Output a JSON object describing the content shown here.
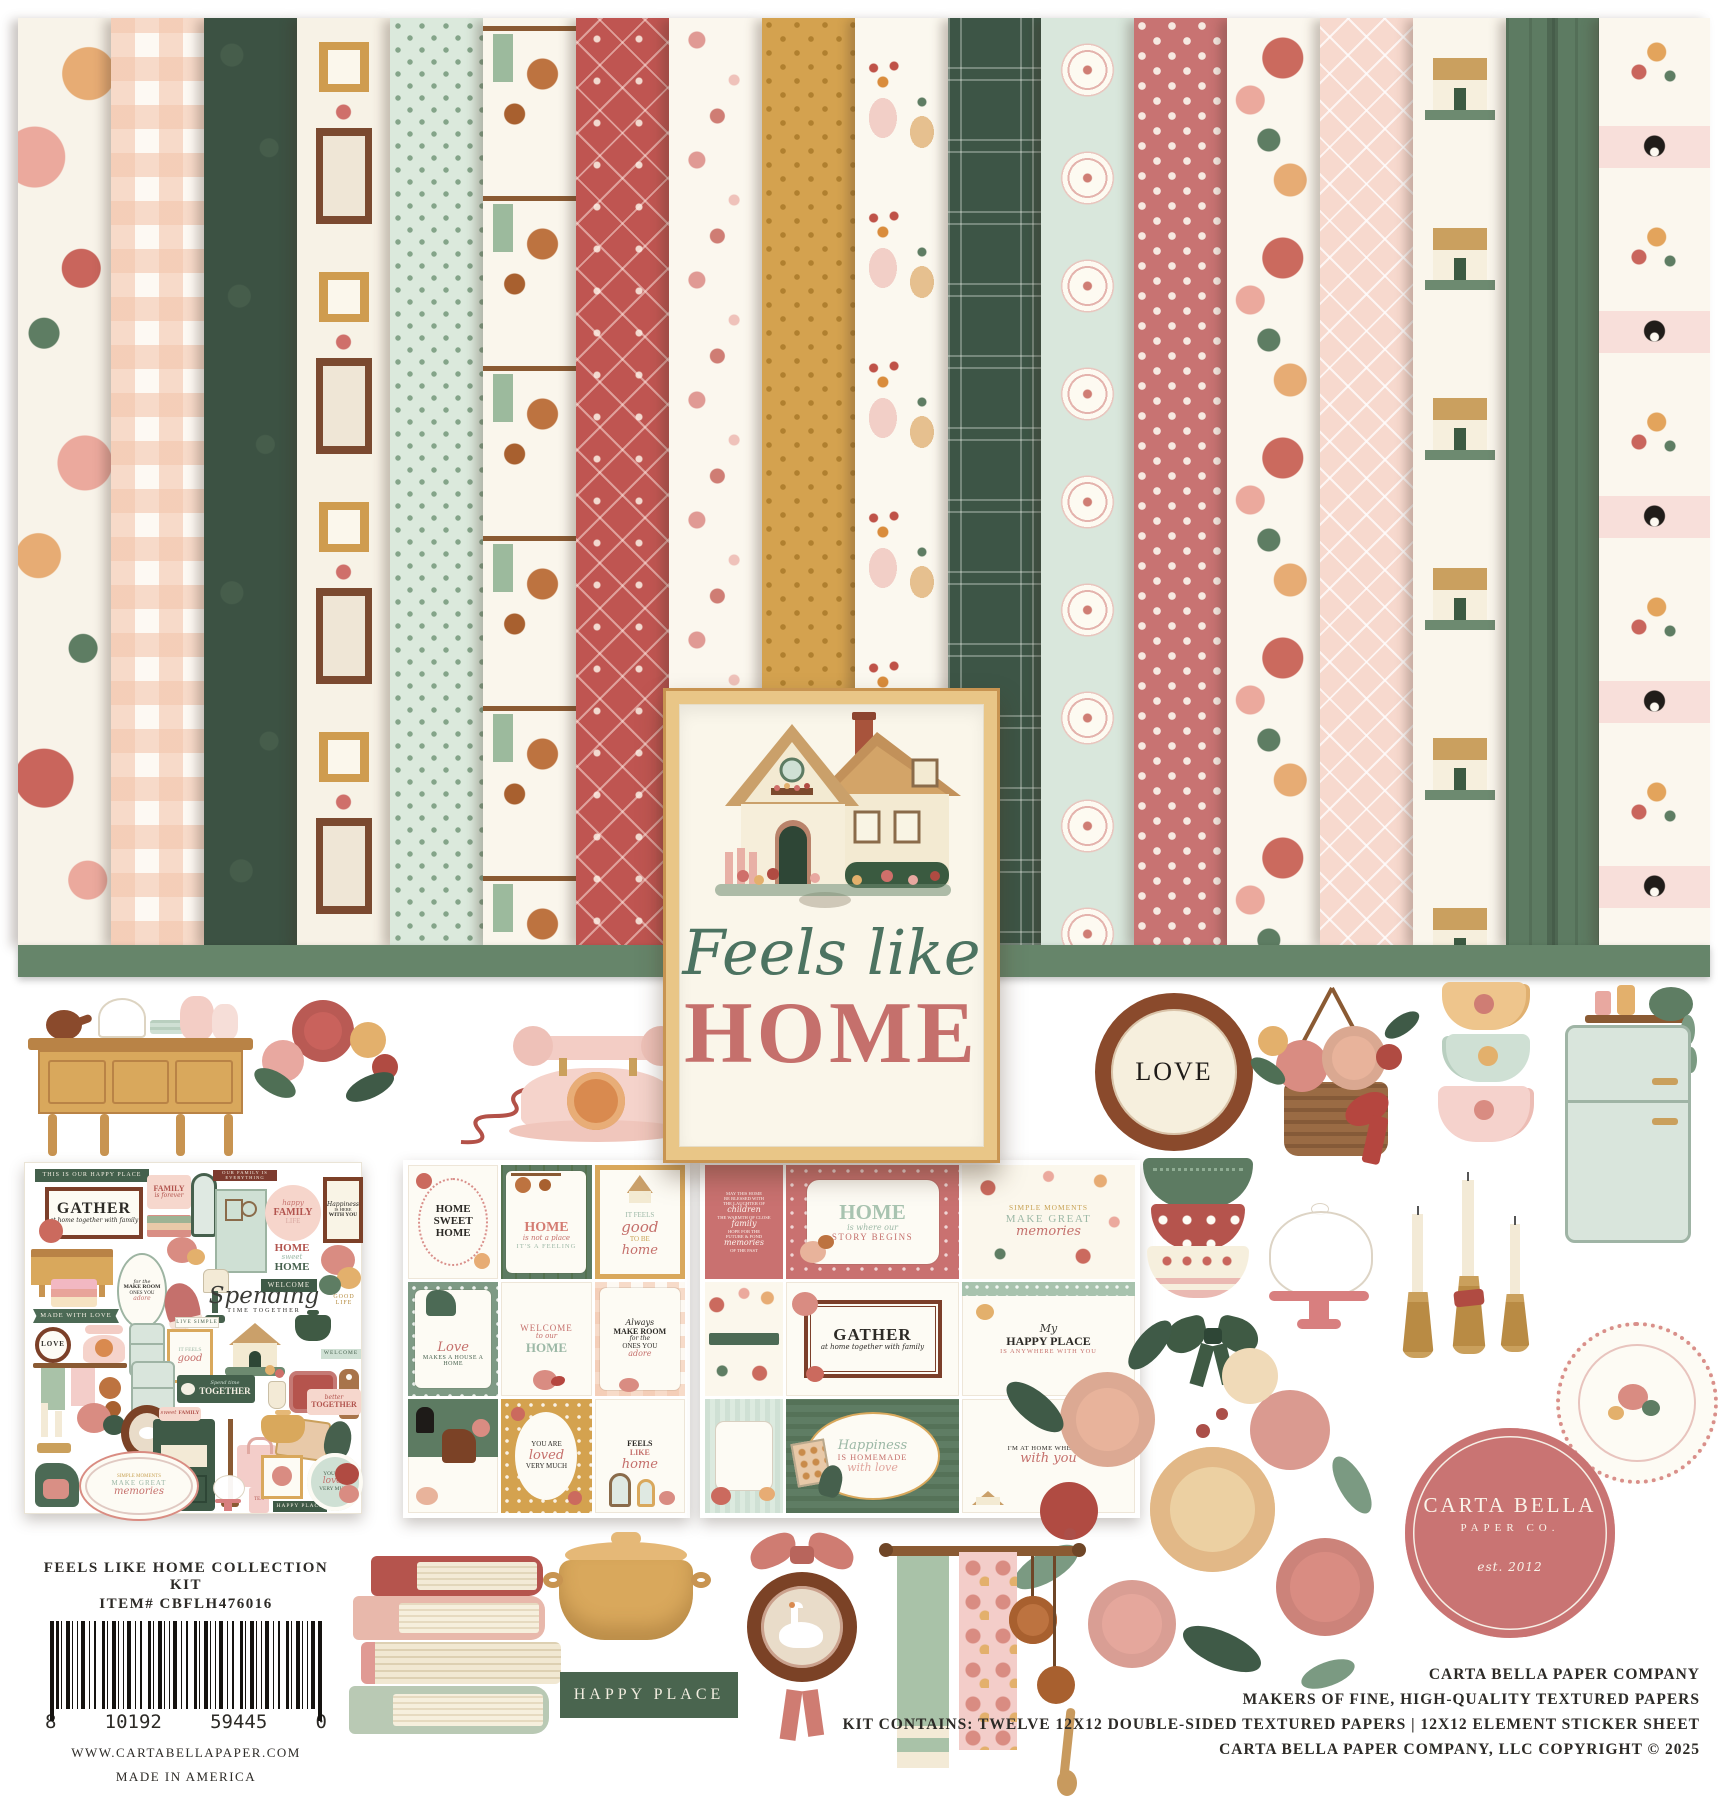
{
  "palette": {
    "rose": "#c5706c",
    "deep_red": "#bf5551",
    "dark_green": "#3c5243",
    "sage_band": "#66856a",
    "beadboard_green": "#5d7b62",
    "mint": "#dbe9dc",
    "mustard": "#d4a24f",
    "peach_gingham": "#f3c6ad",
    "pink_lattice": "#f7d9ce",
    "cream": "#f8f3e9",
    "gold_frame": "#d9a85c",
    "frame_brown": "#7c3f2a",
    "logo_rose": "#c97473",
    "ink": "#2c2a26"
  },
  "title": {
    "script": "Feels like",
    "main": "HOME"
  },
  "love_plate": "LOVE",
  "happy_place_tag": "HAPPY PLACE",
  "logo": {
    "name": "CARTA BELLA",
    "sub": "PAPER CO.",
    "est": "est. 2012"
  },
  "left_block": {
    "title": "FEELS LIKE HOME COLLECTION KIT",
    "item": "ITEM# CBFLH476016",
    "bc1": "8",
    "bc2": "10192",
    "bc3": "59445",
    "bc4": "0",
    "website": "WWW.CARTABELLAPAPER.COM",
    "origin": "MADE IN AMERICA"
  },
  "right_block": {
    "l1": "CARTA BELLA PAPER COMPANY",
    "l2": "MAKERS OF FINE, HIGH-QUALITY TEXTURED PAPERS",
    "l3": "KIT CONTAINS: TWELVE 12X12 DOUBLE-SIDED TEXTURED PAPERS | 12X12 ELEMENT STICKER SHEET",
    "l4": "CARTA BELLA PAPER COMPANY, LLC COPYRIGHT © 2025"
  },
  "sheet1": {
    "happy_place_banner": "THIS IS OUR HAPPY PLACE",
    "gather": "GATHER",
    "gather_sub": "at home together with family",
    "family": "FAMILY",
    "family_sub": "is forever",
    "family_everything": "OUR FAMILY IS EVERYTHING",
    "happy": "happy",
    "family2": "FAMILY",
    "life": "LIFE",
    "happiness": "Happiness",
    "is_here": "IS HERE",
    "with_you": "WITH YOU",
    "home1": "HOME",
    "sweet": "sweet",
    "home2": "HOME",
    "welcome": "WELCOME",
    "spending": "Spending",
    "time_together": "TIME TOGETHER",
    "make_room": "MAKE ROOM",
    "for_the": "for the",
    "ones_you": "ONES YOU",
    "adore": "adore",
    "made_with_love": "MADE WITH LOVE",
    "love": "LOVE",
    "live_simple": "LIVE SIMPLE",
    "good_life": "GOOD LIFE",
    "it_feels": "IT FEELS",
    "good": "good",
    "spend_time": "Spend time",
    "together": "TOGETHER",
    "better": "better",
    "together2": "TOGETHER",
    "sweet2": "sweet",
    "family3": "FAMILY",
    "simple_moments": "SIMPLE MOMENTS",
    "make_great": "MAKE GREAT",
    "memories": "memories",
    "you_are": "YOU ARE",
    "loved": "loved",
    "very_much": "VERY MUCH",
    "happy_place": "HAPPY PLACE",
    "tea": "TEA"
  },
  "sheet2": {
    "c1": {
      "l1": "HOME",
      "l2": "SWEET",
      "l3": "HOME"
    },
    "c2": {
      "l1": "HOME",
      "l2": "is not a place",
      "l3": "IT'S A FEELING"
    },
    "c3": {
      "l1": "IT FEELS",
      "l2": "good",
      "l3": "TO BE",
      "l4": "home"
    },
    "c4": {
      "l1": "Love",
      "l2": "MAKES A HOUSE A HOME"
    },
    "c5": {
      "l1": "WELCOME",
      "l2": "to our",
      "l3": "HOME"
    },
    "c6": {
      "l1": "Always",
      "l2": "MAKE ROOM",
      "l3": "for the",
      "l4": "ONES YOU",
      "l5": "adore"
    },
    "c8": {
      "l1": "YOU ARE",
      "l2": "loved",
      "l3": "VERY MUCH"
    },
    "c9": {
      "l1": "FEELS",
      "l2": "LIKE",
      "l3": "home"
    }
  },
  "sheet3": {
    "blessing": [
      "MAY THIS HOME",
      "BE BLESSED WITH",
      "THE LAUGHTER OF",
      "children",
      "THE WARMTH OF CLOSE",
      "family",
      "HOPE FOR THE",
      "FUTURE & FOND",
      "memories",
      "OF THE PAST"
    ],
    "story": {
      "l1": "HOME",
      "l2": "is where our",
      "l3": "STORY BEGINS"
    },
    "moments": {
      "l1": "SIMPLE MOMENTS",
      "l2": "MAKE GREAT",
      "l3": "memories"
    },
    "gather": {
      "l1": "GATHER",
      "l2": "at home together with family"
    },
    "happy": {
      "l1": "My",
      "l2": "HAPPY PLACE",
      "l3": "IS ANYWHERE WITH YOU"
    },
    "homemade": {
      "l1": "Happiness",
      "l2": "IS HOMEMADE",
      "l3": "with love"
    },
    "withyou": {
      "l1": "I'M AT HOME WHEN I'M",
      "l2": "with you"
    }
  }
}
